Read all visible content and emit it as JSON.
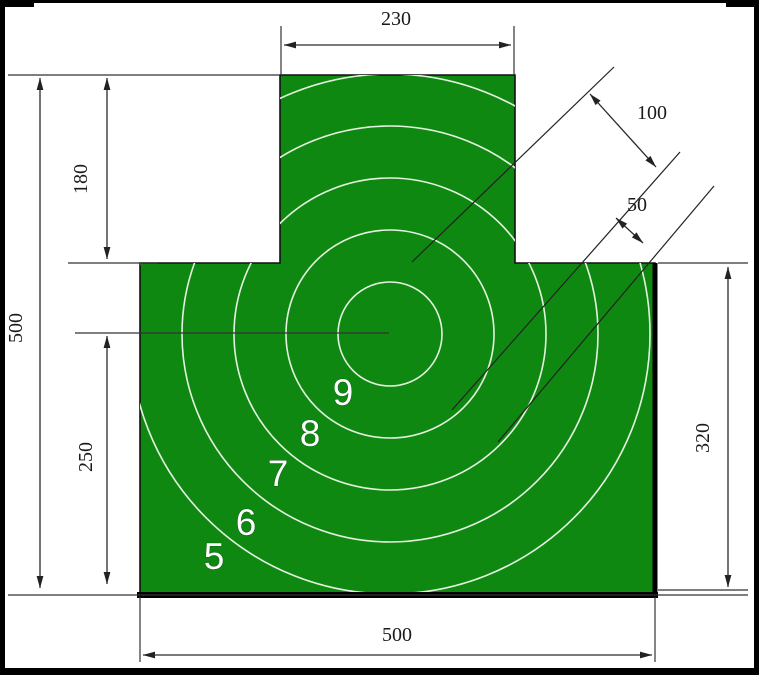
{
  "drawing": {
    "type": "target-dimension-diagram",
    "dims": {
      "top_width": "230",
      "head_height": "180",
      "overall_height": "500",
      "center_to_bottom": "250",
      "gap_large": "100",
      "gap_small": "50",
      "shoulder_to_bottom": "320",
      "bottom_width": "500"
    },
    "rings": {
      "numbers": [
        "9",
        "8",
        "7",
        "6",
        "5"
      ],
      "ring_spacing_units": 50,
      "ring_radii_units": [
        50,
        100,
        150,
        200,
        250
      ]
    },
    "colors": {
      "target_green": "#0f8812",
      "ring_line": "#e4f3df",
      "outline": "#111111",
      "dim_line": "#2a2a2a",
      "frame_black": "#000000"
    }
  }
}
